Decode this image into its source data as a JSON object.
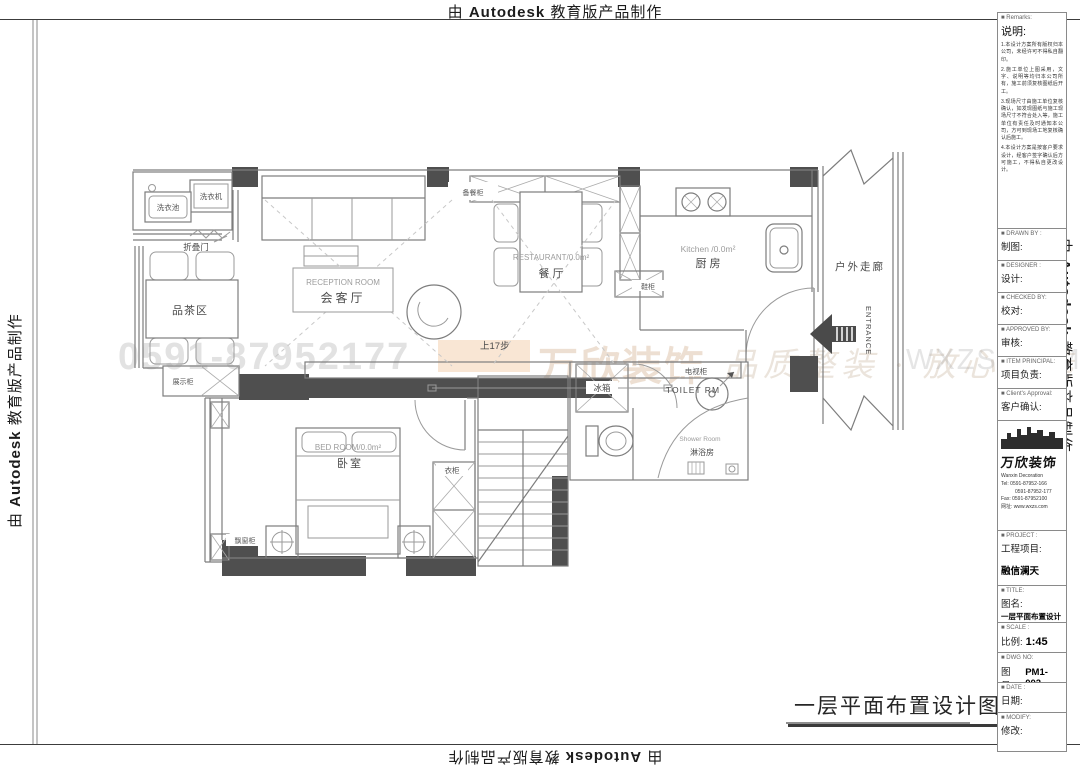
{
  "banner": {
    "prefix": "由",
    "brand": "Autodesk",
    "suffix": "教育版产品制作"
  },
  "watermark": {
    "phone": "0591-87952177",
    "brand": "万欣装饰",
    "tagline": "品质整装 · 放心之选",
    "domain": "WXZS.COM"
  },
  "plan": {
    "title": "一层平面布置设计图",
    "labels": {
      "laundry_sink": "洗衣池",
      "washer": "洗衣机",
      "folding_door": "折叠门",
      "tea_area": "品茶区",
      "reception_en": "RECEPTION ROOM",
      "reception_cn": "会客厅",
      "sideboard": "备餐柜",
      "restaurant_en": "RESTAURANT/0.0m²",
      "restaurant_cn": "餐 厅",
      "kitchen_en": "Kitchen /0.0m²",
      "kitchen_cn": "厨 房",
      "shoe_cabinet": "鞋柜",
      "corridor": "户外走廊",
      "entrance": "ENTRANCE",
      "display_cabinet": "展示柜",
      "tv_cabinet": "电视柜",
      "stairs_up": "上17步",
      "fridge": "冰箱",
      "toilet": "TOILET RM",
      "shower_en": "Shower Room",
      "shower_cn": "淋浴房",
      "bedroom_en": "BED ROOM/0.0m²",
      "bedroom_cn": "卧室",
      "wardrobe": "衣柜",
      "bay_cabinet": "飘窗柜"
    }
  },
  "titleblock": {
    "remarks": {
      "header_en": "■ Remarks:",
      "header_cn": "说明:",
      "notes": [
        "1.本设计方案所有版权归本公司，未经许可不得私自翻印。",
        "2.施工单位上图采用，文字、说明等均归本公司所有，施工前须复核图纸后开工。",
        "3.现场尺寸由施工单位复核确认，如发现图纸与施工现场尺寸不符合处入等，施工单位有责任及时通知本公司，方可到现场工地复核确认后施工。",
        "4.本设计方案是按客户要求设计，经客户签字确认后方可施工，不得私自更改设计。"
      ]
    },
    "fields": [
      {
        "en": "■ DRAWN BY :",
        "cn": "制图:"
      },
      {
        "en": "■ DESIGNER :",
        "cn": "设计:"
      },
      {
        "en": "■ CHECKED BY:",
        "cn": "校对:"
      },
      {
        "en": "■ APPROVED BY:",
        "cn": "审核:"
      },
      {
        "en": "■ ITEM PRINCIPAL:",
        "cn": "项目负责:"
      },
      {
        "en": "■ Client's Approval:",
        "cn": "客户确认:"
      }
    ],
    "company": {
      "name_cn": "万欣装饰",
      "name_en": "Wanxin Decoration",
      "tel1": "Tel: 0591-87952-166",
      "tel2": "0591-87952-177",
      "fax": "Fax: 0591-87952100",
      "web": "网址: www.wxzs.com"
    },
    "project": {
      "en": "■ PROJECT :",
      "cn": "工程项目:",
      "value": "融信澜天"
    },
    "drawing_title": {
      "en": "■ TITLE:",
      "cn": "图名:",
      "value": "一层平面布置设计图"
    },
    "scale": {
      "en": "■ SCALE :",
      "cn": "比例:",
      "value": "1:45"
    },
    "dwg_no": {
      "en": "■ DWG NO:",
      "cn": "图号:",
      "value": "PM1-002"
    },
    "date": {
      "en": "■ DATE :",
      "cn": "日期:"
    },
    "modify": {
      "en": "■ MODIFY:",
      "cn": "修改:"
    }
  }
}
